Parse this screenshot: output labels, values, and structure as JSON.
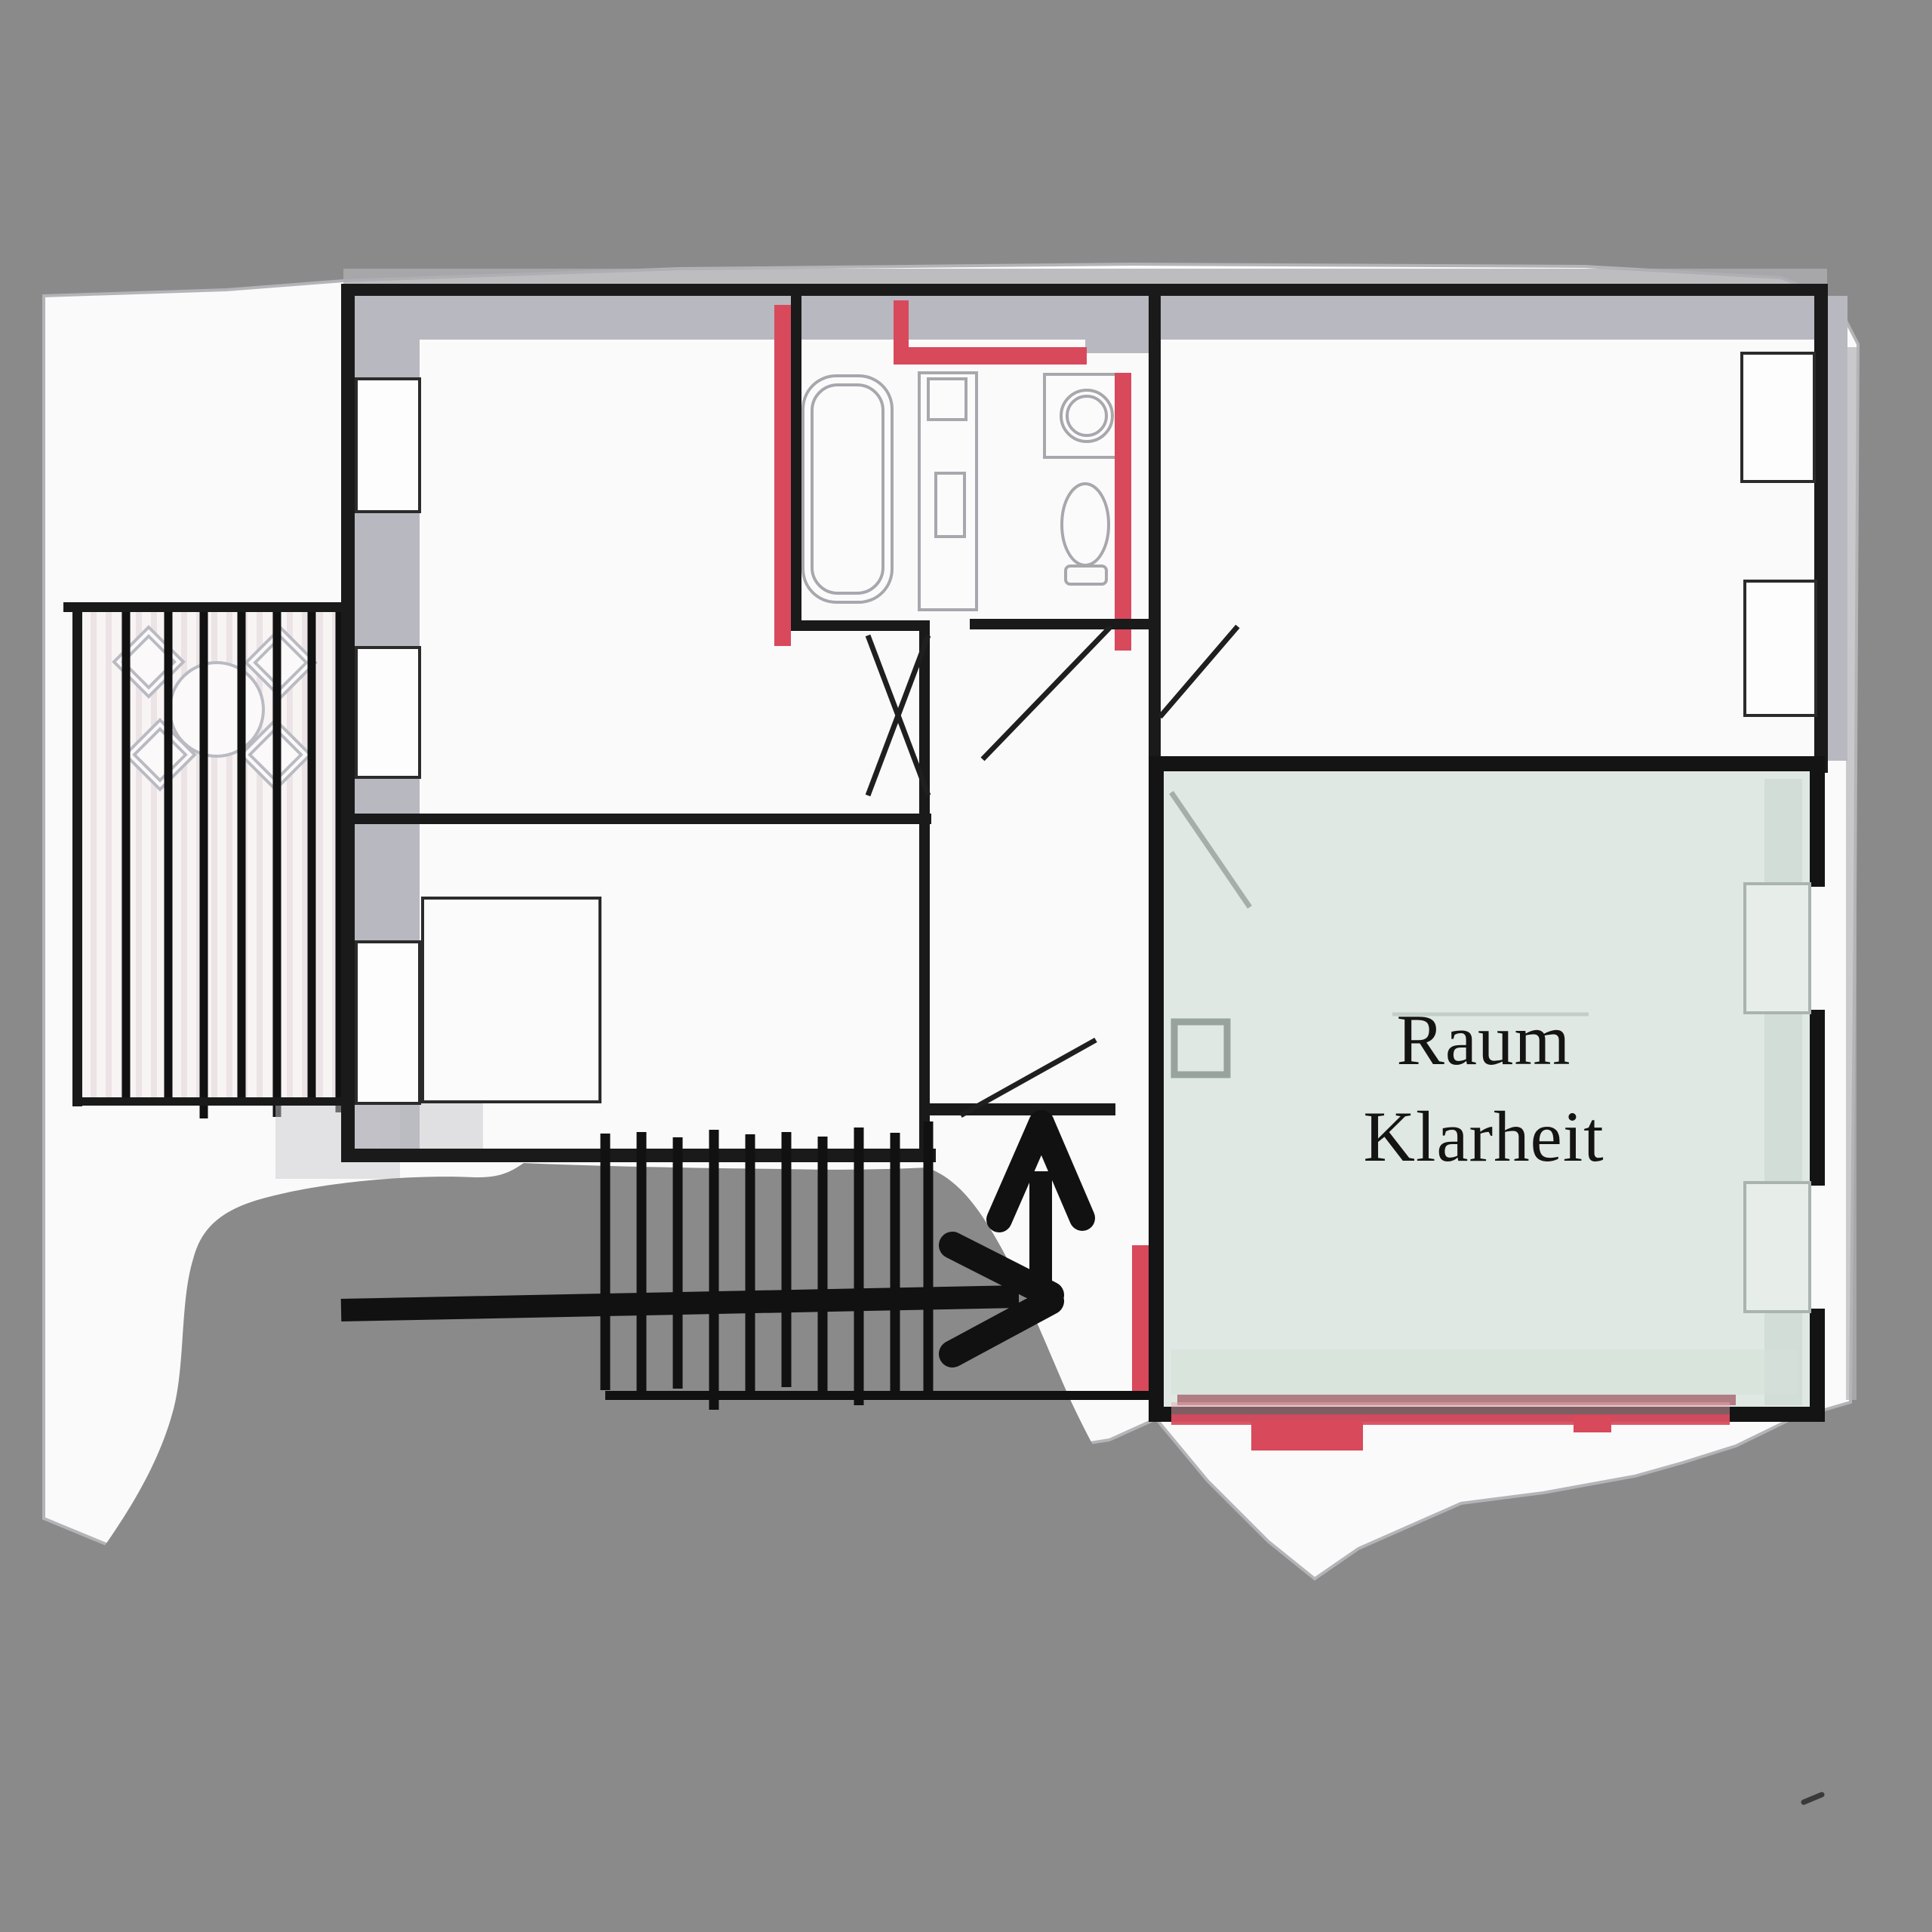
{
  "room_label": {
    "line1": "Raum",
    "line2": "Klarheit"
  },
  "palette": {
    "background": "#8a8a8a",
    "paper": "#fbfafa",
    "wall_black": "#1a1a1a",
    "wall_gray": "#b8b8c0",
    "accent_red": "#d8495c",
    "room_green_fill": "#dfe8e2",
    "marker_black": "#111111"
  }
}
